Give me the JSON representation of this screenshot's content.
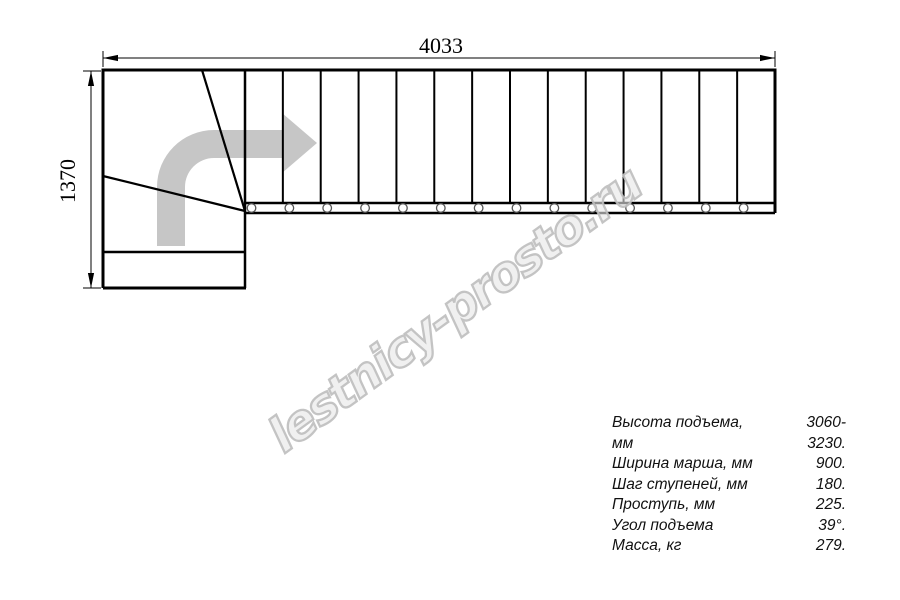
{
  "watermark": {
    "text": "lestnicy-prosto.ru",
    "outline_color": "#c4c4c4"
  },
  "dimensions": {
    "total_length_mm": "4033",
    "total_width_mm": "1370"
  },
  "drawing": {
    "type": "staircase-plan-top-view",
    "straight_steps": 14,
    "winder_steps": 3,
    "turn_direction": "left-entry-right-run",
    "arrow_color": "#c6c6c6",
    "line_color": "#000000"
  },
  "specs": {
    "rows": [
      {
        "label": "Высота подъема, мм",
        "value": "3060-3230."
      },
      {
        "label": "Ширина марша, мм",
        "value": "900."
      },
      {
        "label": "Шаг ступеней, мм",
        "value": "180."
      },
      {
        "label": "Проступь, мм",
        "value": "225."
      },
      {
        "label": "Угол подъема",
        "value": "39°."
      },
      {
        "label": "Масса, кг",
        "value": "279."
      }
    ]
  }
}
